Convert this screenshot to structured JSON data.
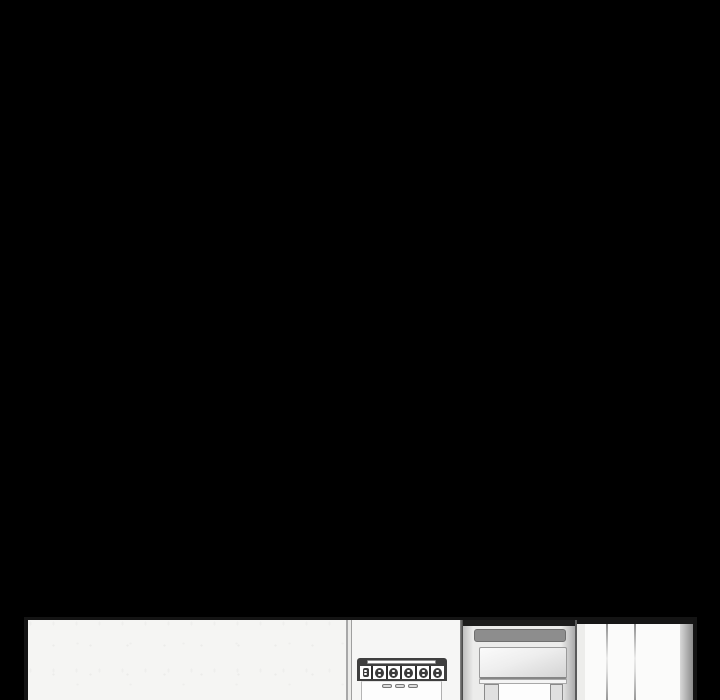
{
  "scene": {
    "type": "webtoon-comic-panel",
    "letterbox_color": "#000000",
    "panel_border_color": "#141414",
    "panel_left": 24,
    "panel_top": 617,
    "panel_width": 673,
    "panel_height": 83
  },
  "kitchen": {
    "wall": {
      "color": "#f5f5f3"
    },
    "stove": {
      "frame_color": "#3f3f3f",
      "knob_count": 5,
      "aux_switch_count": 1,
      "drawer_handle_count": 3,
      "front_color": "#fdfdfd"
    },
    "refrigerator": {
      "body_color": "#ececeb",
      "top_band_color": "#1c1c1c",
      "recessed_handle_color": "#8d8d8d",
      "has_water_dispenser": true,
      "dispenser_post_count": 2
    },
    "cabinet_right": {
      "panel_color": "#fbfbfa",
      "seam_count": 2,
      "edge_strip_color": "#8c8c8c"
    }
  }
}
